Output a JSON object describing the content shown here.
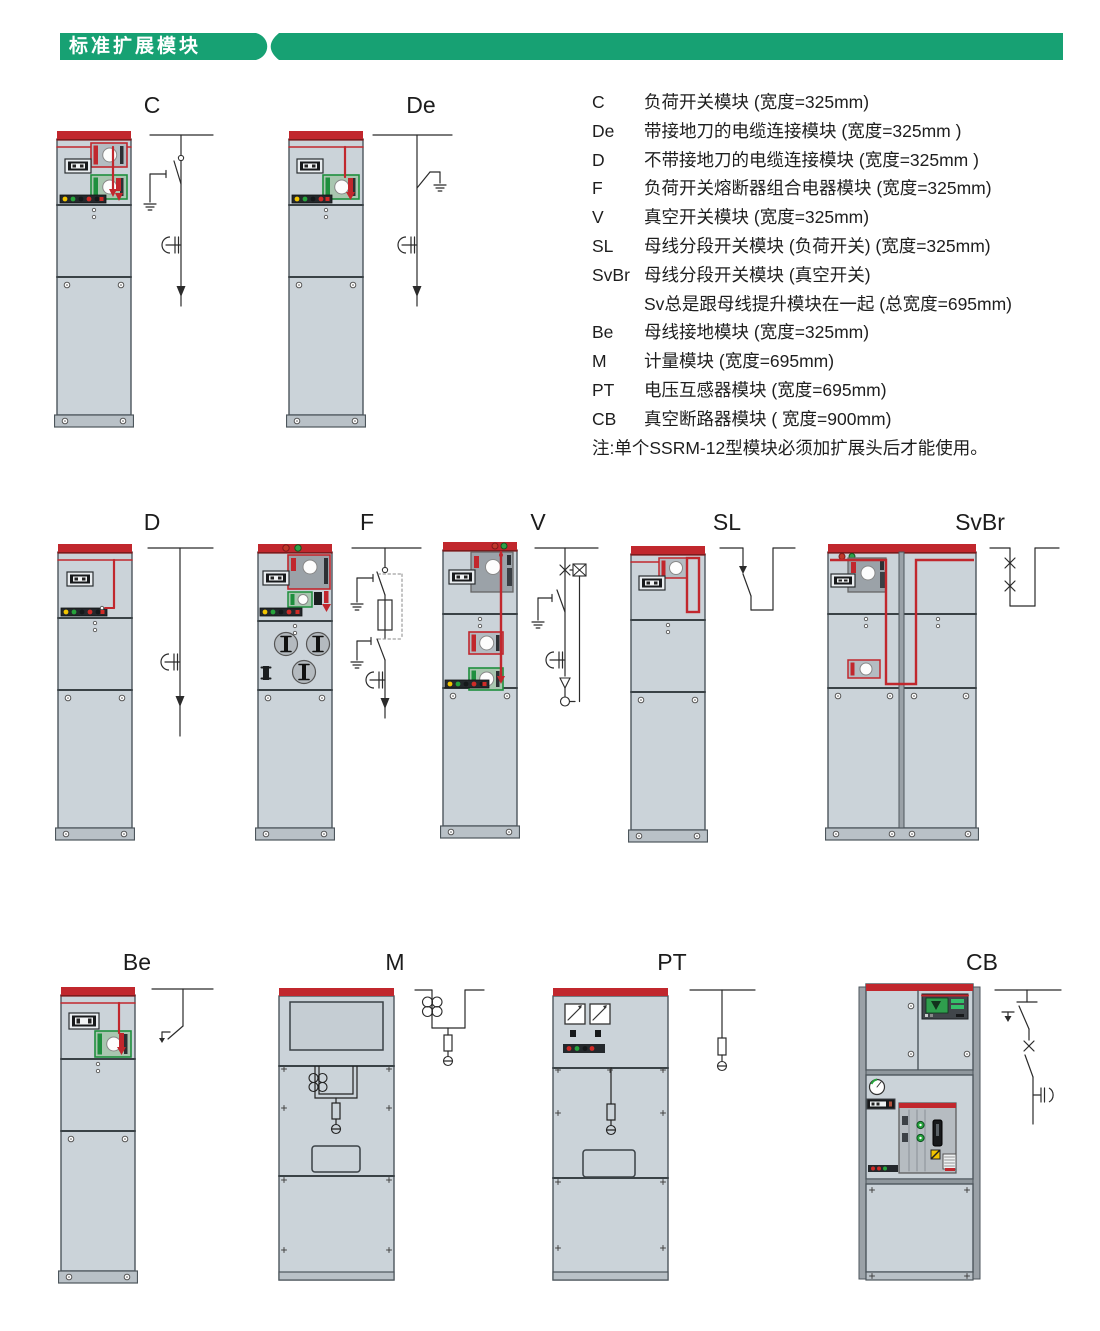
{
  "page": {
    "title": "标准扩展模块"
  },
  "legend": {
    "items": [
      {
        "key": "C",
        "desc": "负荷开关模块 (宽度=325mm)"
      },
      {
        "key": "De",
        "desc": "带接地刀的电缆连接模块 (宽度=325mm )"
      },
      {
        "key": "D",
        "desc": "不带接地刀的电缆连接模块 (宽度=325mm )"
      },
      {
        "key": "F",
        "desc": "负荷开关熔断器组合电器模块 (宽度=325mm)"
      },
      {
        "key": "V",
        "desc": "真空开关模块 (宽度=325mm)"
      },
      {
        "key": "SL",
        "desc": "母线分段开关模块 (负荷开关) (宽度=325mm)"
      },
      {
        "key": "SvBr",
        "desc": "母线分段开关模块 (真空开关)"
      },
      {
        "key": "",
        "desc": "Sv总是跟母线提升模块在一起 (总宽度=695mm)"
      },
      {
        "key": "Be",
        "desc": "母线接地模块 (宽度=325mm)"
      },
      {
        "key": "M",
        "desc": "计量模块 (宽度=695mm)"
      },
      {
        "key": "PT",
        "desc": "电压互感器模块 (宽度=695mm)"
      },
      {
        "key": "CB",
        "desc": "真空断路器模块 ( 宽度=900mm)"
      }
    ],
    "note": "注:单个SSRM-12型模块必须加扩展头后才能使用。"
  },
  "figures": {
    "c": {
      "label": "C"
    },
    "de": {
      "label": "De"
    },
    "d": {
      "label": "D"
    },
    "f": {
      "label": "F"
    },
    "v": {
      "label": "V"
    },
    "sl": {
      "label": "SL"
    },
    "svbr": {
      "label": "SvBr"
    },
    "be": {
      "label": "Be"
    },
    "m": {
      "label": "M"
    },
    "pt": {
      "label": "PT"
    },
    "cb": {
      "label": "CB"
    }
  },
  "colors": {
    "accent_green": "#17a173",
    "busbar_red": "#c1272d",
    "cabinet_gray": "#cbd3d9"
  }
}
